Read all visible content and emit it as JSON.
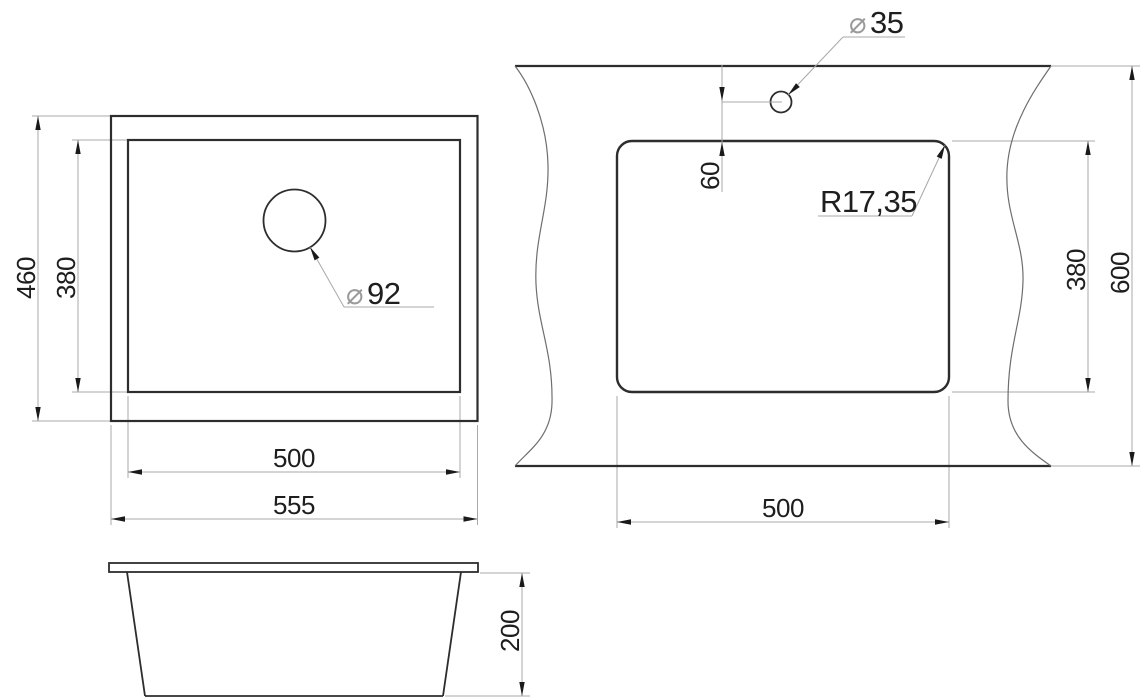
{
  "drawing": {
    "type": "sink-technical-drawing",
    "background_color": "#ffffff",
    "outline_color": "#2d2d2d",
    "dimension_line_color": "#a8a8a8",
    "text_color": "#1e1e1e",
    "diameter_symbol_color": "#9a9a9a",
    "diameter_symbol": "⌀",
    "top_view": {
      "outer_width": "555",
      "bowl_width": "500",
      "outer_depth": "460",
      "bowl_depth": "380",
      "drain_hole_diameter": "92"
    },
    "cutout_view": {
      "cutout_width": "500",
      "cutout_height": "380",
      "counter_depth": "600",
      "faucet_hole_offset": "60",
      "faucet_hole_diameter": "35",
      "corner_radius": "R17,35"
    },
    "side_view": {
      "overall_height": "200"
    }
  }
}
